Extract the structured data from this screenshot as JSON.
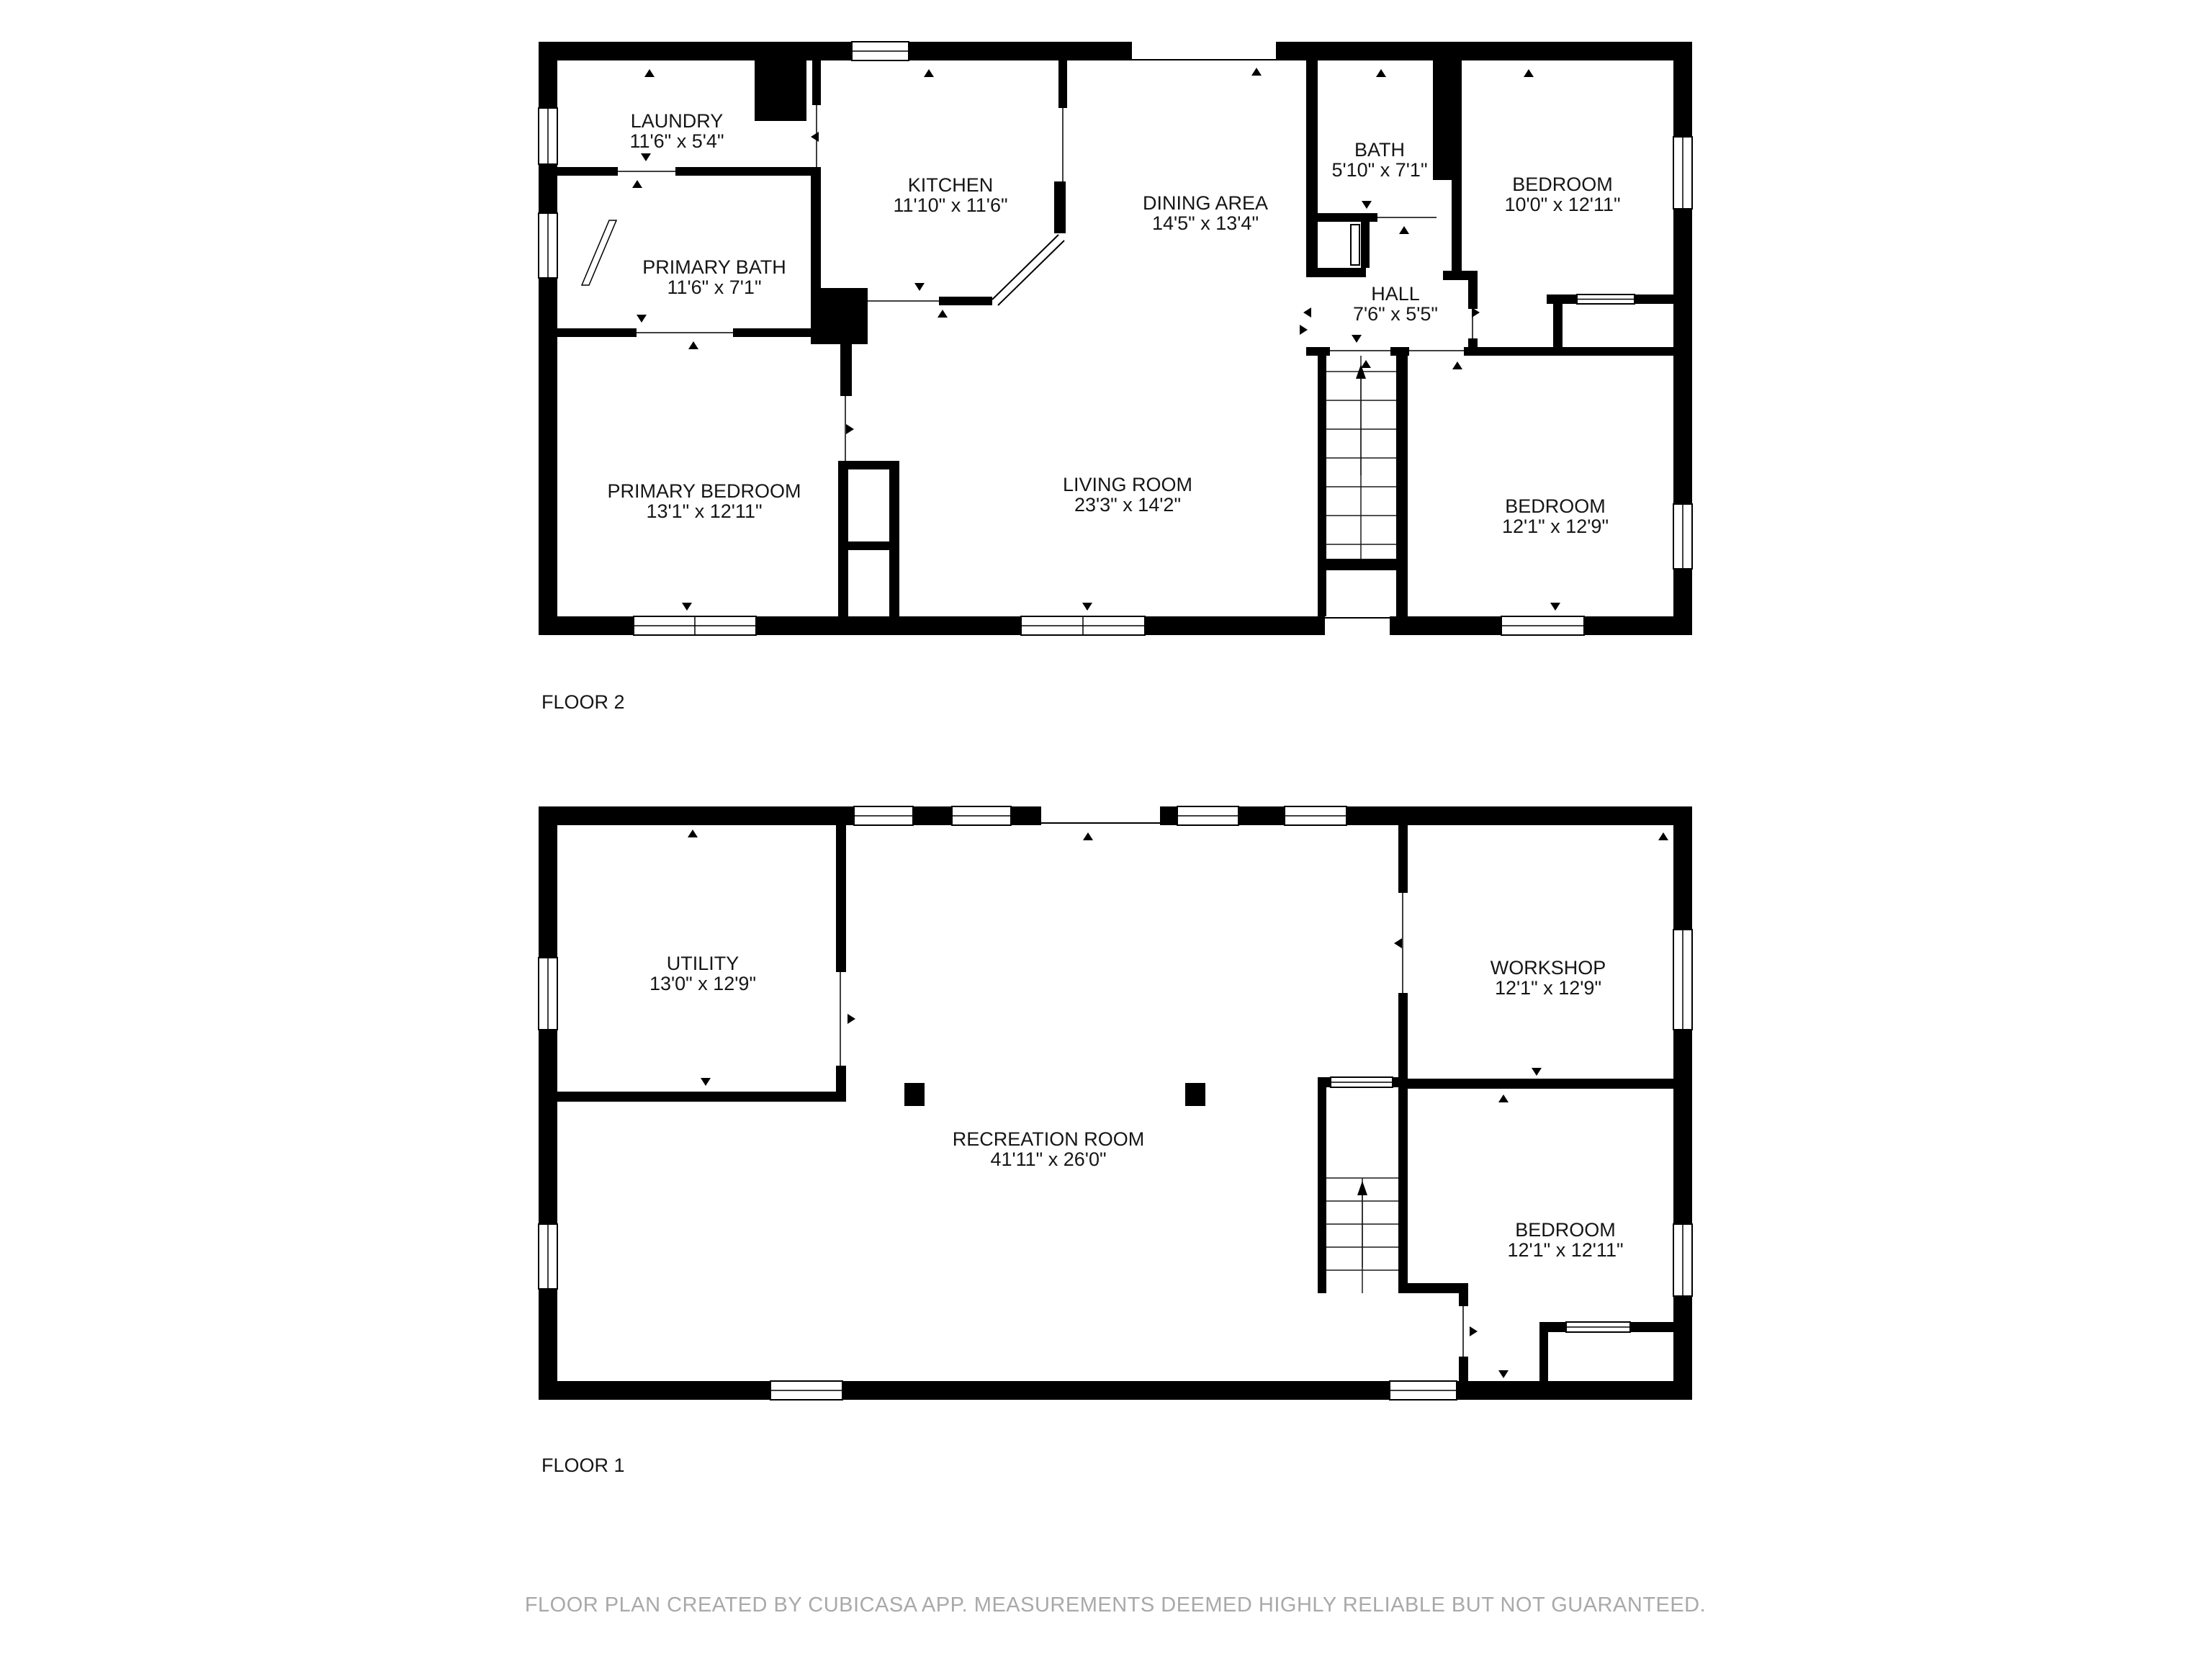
{
  "colors": {
    "walls": "#000000",
    "background": "#ffffff",
    "footer_text": "#a9a9a9"
  },
  "floors": [
    {
      "label": "FLOOR 2",
      "rooms": [
        {
          "name": "LAUNDRY",
          "dims": "11'6\" x 5'4\""
        },
        {
          "name": "KITCHEN",
          "dims": "11'10\" x 11'6\""
        },
        {
          "name": "DINING AREA",
          "dims": "14'5\" x 13'4\""
        },
        {
          "name": "BATH",
          "dims": "5'10\" x 7'1\""
        },
        {
          "name": "BEDROOM",
          "dims": "10'0\" x 12'11\""
        },
        {
          "name": "PRIMARY BATH",
          "dims": "11'6\" x 7'1\""
        },
        {
          "name": "HALL",
          "dims": "7'6\" x 5'5\""
        },
        {
          "name": "PRIMARY BEDROOM",
          "dims": "13'1\" x 12'11\""
        },
        {
          "name": "LIVING ROOM",
          "dims": "23'3\" x 14'2\""
        },
        {
          "name": "BEDROOM",
          "dims": "12'1\" x 12'9\""
        }
      ]
    },
    {
      "label": "FLOOR 1",
      "rooms": [
        {
          "name": "UTILITY",
          "dims": "13'0\" x 12'9\""
        },
        {
          "name": "WORKSHOP",
          "dims": "12'1\" x 12'9\""
        },
        {
          "name": "RECREATION ROOM",
          "dims": "41'11\" x 26'0\""
        },
        {
          "name": "BEDROOM",
          "dims": "12'1\" x 12'11\""
        }
      ]
    }
  ],
  "footer": {
    "text": "FLOOR PLAN CREATED BY CUBICASA APP. MEASUREMENTS DEEMED HIGHLY RELIABLE BUT NOT GUARANTEED."
  }
}
